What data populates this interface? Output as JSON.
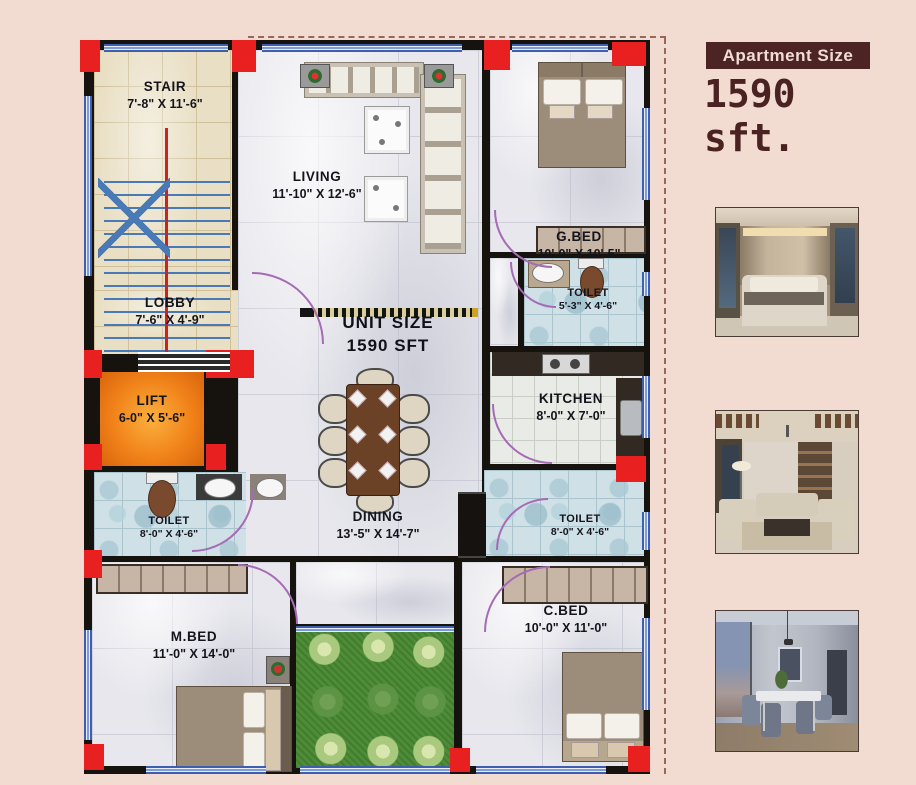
{
  "header": {
    "badge_label": "Apartment Size",
    "size_text": "1590 sft."
  },
  "plan": {
    "unit": {
      "line1": "UNIT SIZE",
      "line2": "1590 SFT"
    },
    "rooms": {
      "stair": {
        "label": "STAIR",
        "dims": "7'-8\" X 11'-6\""
      },
      "living": {
        "label": "LIVING",
        "dims": "11'-10\" X 12'-6\""
      },
      "gbed": {
        "label": "G.BED",
        "dims": "10'-0\" X 10'-5\""
      },
      "lobby": {
        "label": "LOBBY",
        "dims": "7'-6\" X 4'-9\""
      },
      "toilet_top": {
        "label": "TOILET",
        "dims": "5'-3\" X 4'-6\""
      },
      "kitchen": {
        "label": "KITCHEN",
        "dims": "8'-0\" X 7'-0\""
      },
      "lift": {
        "label": "LIFT",
        "dims": "6-0\" X 5'-6\""
      },
      "toilet_left": {
        "label": "TOILET",
        "dims": "8'-0\" X 4'-6\""
      },
      "dining": {
        "label": "DINING",
        "dims": "13'-5\" X 14'-7\""
      },
      "toilet_right": {
        "label": "TOILET",
        "dims": "8'-0\" X 4'-6\""
      },
      "mbed": {
        "label": "M.BED",
        "dims": "11'-0\" X 14'-0\""
      },
      "cbed": {
        "label": "C.BED",
        "dims": "10'-0\" X 11'-0\""
      }
    }
  },
  "photos": [
    {
      "name": "bedroom-interior-render"
    },
    {
      "name": "living-room-interior-render"
    },
    {
      "name": "dining-room-interior-render"
    }
  ],
  "colors": {
    "page_background": "#f2dcd2",
    "wall_black": "#16120e",
    "column_red": "#e8201f",
    "window_blue": "#3d5fae",
    "lift_orange": "#f1831a",
    "garden_green": "#4e8c38",
    "door_arc_purple": "#a66bb5",
    "badge_background": "#4d2424",
    "badge_text": "#f2ddd3",
    "size_text_color": "#4a2222"
  }
}
